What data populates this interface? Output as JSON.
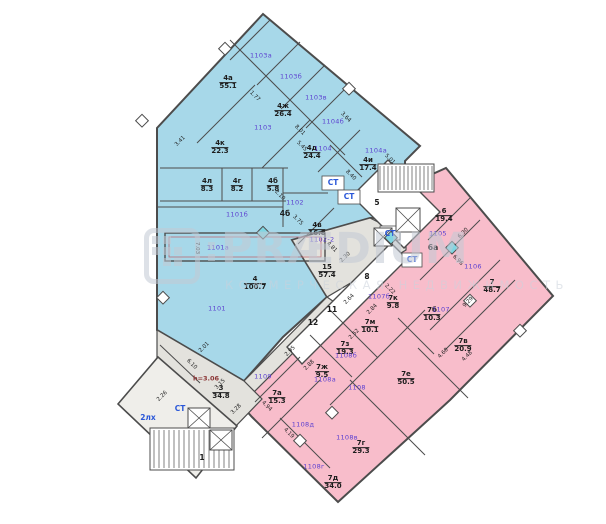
{
  "watermark": {
    "brand": "PRÆDIUM",
    "tagline": "КОММЕРЧЕСКАЯ НЕДВИЖИМОСТЬ"
  },
  "palette": {
    "blue": "#a7d8e9",
    "pink": "#f8bdcb",
    "corridor": "#e3e2dd",
    "lobby": "#efeeea",
    "wall": "#4c4c4c",
    "redwall": "#c06a74",
    "unit": "#5b3fd0",
    "service": "#2a57d8",
    "note": "#8a3434",
    "dim": "#1f1f1f",
    "marker": "#7fd6e2",
    "wm": "#c3cad5",
    "wm2": "#ccd2dc"
  },
  "plan": {
    "room_labels": [
      {
        "n": "4а",
        "a": "55.1",
        "x": 228,
        "y": 83
      },
      {
        "n": "4ж",
        "a": "26.4",
        "x": 283,
        "y": 111
      },
      {
        "n": "4к",
        "a": "22.3",
        "x": 220,
        "y": 148
      },
      {
        "n": "4л",
        "a": "8.3",
        "x": 207,
        "y": 186
      },
      {
        "n": "4г",
        "a": "8.2",
        "x": 237,
        "y": 186
      },
      {
        "n": "4б",
        "a": "5.8",
        "x": 273,
        "y": 186
      },
      {
        "n": "4д",
        "a": "24.4",
        "x": 312,
        "y": 153
      },
      {
        "n": "4и",
        "a": "17.4",
        "x": 368,
        "y": 165
      },
      {
        "n": "4в",
        "a": "16.8",
        "x": 317,
        "y": 230
      },
      {
        "n": "4",
        "a": "100.7",
        "x": 255,
        "y": 284
      },
      {
        "n": "15",
        "a": "57.4",
        "x": 327,
        "y": 272
      },
      {
        "n": "3",
        "a": "34.8",
        "x": 221,
        "y": 393
      },
      {
        "n": "6",
        "a": "19.4",
        "x": 444,
        "y": 216
      },
      {
        "n": "7",
        "a": "48.7",
        "x": 492,
        "y": 287
      },
      {
        "n": "7к",
        "a": "9.8",
        "x": 393,
        "y": 303
      },
      {
        "n": "7б",
        "a": "10.3",
        "x": 432,
        "y": 315
      },
      {
        "n": "7м",
        "a": "10.1",
        "x": 370,
        "y": 327
      },
      {
        "n": "7з",
        "a": "19.3",
        "x": 345,
        "y": 349
      },
      {
        "n": "7ж",
        "a": "9.5",
        "x": 322,
        "y": 372
      },
      {
        "n": "7е",
        "a": "50.5",
        "x": 406,
        "y": 379
      },
      {
        "n": "7в",
        "a": "20.9",
        "x": 463,
        "y": 346
      },
      {
        "n": "7г",
        "a": "29.3",
        "x": 361,
        "y": 448
      },
      {
        "n": "7д",
        "a": "34.0",
        "x": 333,
        "y": 483
      },
      {
        "n": "7а",
        "a": "15.3",
        "x": 277,
        "y": 398
      }
    ],
    "unit_labels": [
      {
        "t": "1103а",
        "x": 261,
        "y": 56
      },
      {
        "t": "1103б",
        "x": 291,
        "y": 77
      },
      {
        "t": "1103в",
        "x": 316,
        "y": 98
      },
      {
        "t": "1103",
        "x": 263,
        "y": 128
      },
      {
        "t": "1104б",
        "x": 333,
        "y": 122
      },
      {
        "t": "1104",
        "x": 323,
        "y": 149
      },
      {
        "t": "1104а",
        "x": 376,
        "y": 151
      },
      {
        "t": "1102",
        "x": 295,
        "y": 203
      },
      {
        "t": "1101б",
        "x": 237,
        "y": 215
      },
      {
        "t": "1101а",
        "x": 218,
        "y": 248
      },
      {
        "t": "1102-2",
        "x": 322,
        "y": 240
      },
      {
        "t": "1101",
        "x": 217,
        "y": 309
      },
      {
        "t": "1105",
        "x": 438,
        "y": 234
      },
      {
        "t": "1106",
        "x": 473,
        "y": 267
      },
      {
        "t": "1107",
        "x": 441,
        "y": 310
      },
      {
        "t": "1107б",
        "x": 379,
        "y": 297
      },
      {
        "t": "1108",
        "x": 357,
        "y": 388
      },
      {
        "t": "1108а",
        "x": 325,
        "y": 380
      },
      {
        "t": "1108б",
        "x": 346,
        "y": 356
      },
      {
        "t": "1108в",
        "x": 347,
        "y": 438
      },
      {
        "t": "1108г",
        "x": 314,
        "y": 467
      },
      {
        "t": "1108д",
        "x": 303,
        "y": 425
      },
      {
        "t": "1109",
        "x": 263,
        "y": 377
      }
    ],
    "plain_labels": [
      {
        "t": "4б",
        "x": 285,
        "y": 214
      },
      {
        "t": "6а",
        "x": 433,
        "y": 248
      },
      {
        "t": "5",
        "x": 377,
        "y": 203
      },
      {
        "t": "8",
        "x": 367,
        "y": 277
      },
      {
        "t": "11",
        "x": 332,
        "y": 310
      },
      {
        "t": "12",
        "x": 313,
        "y": 323
      },
      {
        "t": "1",
        "x": 202,
        "y": 458
      }
    ],
    "service_labels": [
      {
        "t": "СТ",
        "x": 333,
        "y": 183
      },
      {
        "t": "СТ",
        "x": 349,
        "y": 197
      },
      {
        "t": "СТ",
        "x": 390,
        "y": 234
      },
      {
        "t": "СТ",
        "x": 412,
        "y": 260
      },
      {
        "t": "СТ",
        "x": 180,
        "y": 409
      },
      {
        "t": "2лх",
        "x": 148,
        "y": 418
      }
    ],
    "note_labels": [
      {
        "t": "h=3.06",
        "x": 206,
        "y": 379
      }
    ],
    "dim_labels": [
      {
        "t": "3.41",
        "x": 181,
        "y": 142,
        "r": -45
      },
      {
        "t": "1.77",
        "x": 254,
        "y": 97,
        "r": 45
      },
      {
        "t": "8.01",
        "x": 299,
        "y": 131,
        "r": 45
      },
      {
        "t": "5.45",
        "x": 301,
        "y": 147,
        "r": 45
      },
      {
        "t": "3.64",
        "x": 345,
        "y": 118,
        "r": 45
      },
      {
        "t": "5.01",
        "x": 389,
        "y": 160,
        "r": 45
      },
      {
        "t": "8.40",
        "x": 350,
        "y": 176,
        "r": 45
      },
      {
        "t": "2.10",
        "x": 279,
        "y": 196,
        "r": 45
      },
      {
        "t": "3.75",
        "x": 297,
        "y": 221,
        "r": 45
      },
      {
        "t": "4.81",
        "x": 331,
        "y": 248,
        "r": 45
      },
      {
        "t": "2.30",
        "x": 346,
        "y": 258,
        "r": -45
      },
      {
        "t": "6.30",
        "x": 464,
        "y": 234,
        "r": -45
      },
      {
        "t": "6.96",
        "x": 457,
        "y": 261,
        "r": 45
      },
      {
        "t": "9.29",
        "x": 469,
        "y": 303,
        "r": -45
      },
      {
        "t": "2.01",
        "x": 205,
        "y": 348,
        "r": -45
      },
      {
        "t": "6.10",
        "x": 191,
        "y": 365,
        "r": 45
      },
      {
        "t": "2.26",
        "x": 163,
        "y": 397,
        "r": -45
      },
      {
        "t": "3.28",
        "x": 237,
        "y": 410,
        "r": -45
      },
      {
        "t": "4.19",
        "x": 288,
        "y": 434,
        "r": 45
      },
      {
        "t": "4.94",
        "x": 266,
        "y": 407,
        "r": 45
      },
      {
        "t": "4.60",
        "x": 444,
        "y": 354,
        "r": -45
      },
      {
        "t": "4.48",
        "x": 468,
        "y": 357,
        "r": -45
      },
      {
        "t": "2.52",
        "x": 355,
        "y": 335,
        "r": -45
      },
      {
        "t": "2.88",
        "x": 310,
        "y": 366,
        "r": -45
      },
      {
        "t": "2.84",
        "x": 373,
        "y": 310,
        "r": -45
      },
      {
        "t": "2.64",
        "x": 350,
        "y": 300,
        "r": -45
      },
      {
        "t": "2.95",
        "x": 291,
        "y": 352,
        "r": -45
      },
      {
        "t": "2.22",
        "x": 389,
        "y": 290,
        "r": 45
      },
      {
        "t": "3.15",
        "x": 221,
        "y": 385,
        "r": -45
      },
      {
        "t": "7.03",
        "x": 196,
        "y": 248,
        "r": 90
      }
    ]
  }
}
